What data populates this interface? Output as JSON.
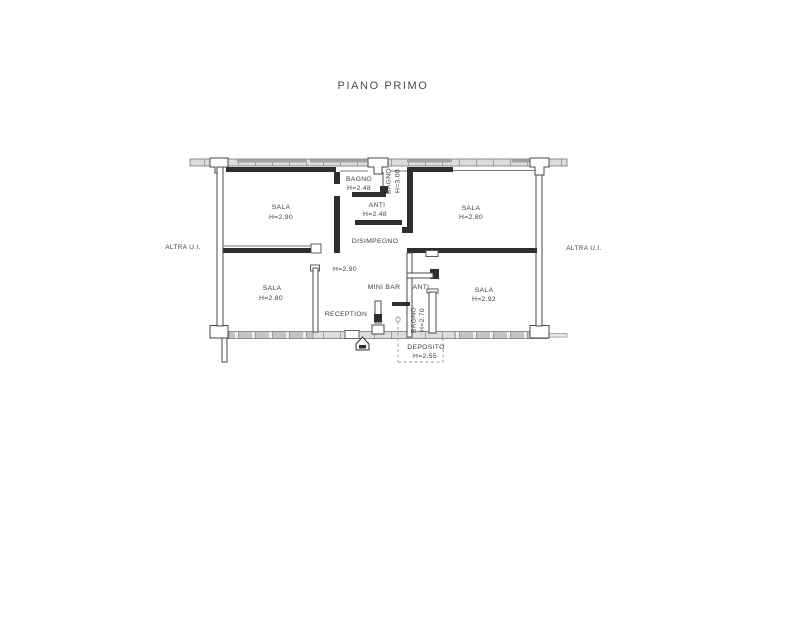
{
  "title": "PIANO PRIMO",
  "colors": {
    "wall_dark": "#2e2e2e",
    "wall_line": "#4a4a4a",
    "thin_line": "#7a7a7a",
    "band_fill": "#dcdcdc",
    "band_block": "#c4c4c4",
    "band_dark_stripe": "#a3a3a3",
    "dash": "#979797",
    "text": "#3f3f3f",
    "background": "#ffffff"
  },
  "plan": {
    "adjacent_units": {
      "left": "ALTRA U.I.",
      "right": "ALTRA U.I."
    },
    "rooms": [
      {
        "id": "sala-nw",
        "name": "SALA",
        "height": "H=2.90"
      },
      {
        "id": "bagno-north",
        "name": "BAGNO",
        "height": "H=2.48"
      },
      {
        "id": "bagno-north-2",
        "name": "BAGNO",
        "height": "H=3.00"
      },
      {
        "id": "anti-north",
        "name": "ANTI",
        "height": "H=2.48"
      },
      {
        "id": "sala-ne",
        "name": "SALA",
        "height": "H=2.80"
      },
      {
        "id": "disimpegno",
        "name": "DISIMPEGNO",
        "height": "H=2.90"
      },
      {
        "id": "sala-sw",
        "name": "SALA",
        "height": "H=2.80"
      },
      {
        "id": "mini-bar",
        "name": "MINI BAR"
      },
      {
        "id": "anti-south",
        "name": "ANTI"
      },
      {
        "id": "bagno-south",
        "name": "BAGNO",
        "height": "H=2.70"
      },
      {
        "id": "reception",
        "name": "RECEPTION"
      },
      {
        "id": "sala-se",
        "name": "SALA",
        "height": "H=2.92"
      },
      {
        "id": "deposito",
        "name": "DEPOSITO",
        "height": "H=2.55"
      }
    ]
  }
}
